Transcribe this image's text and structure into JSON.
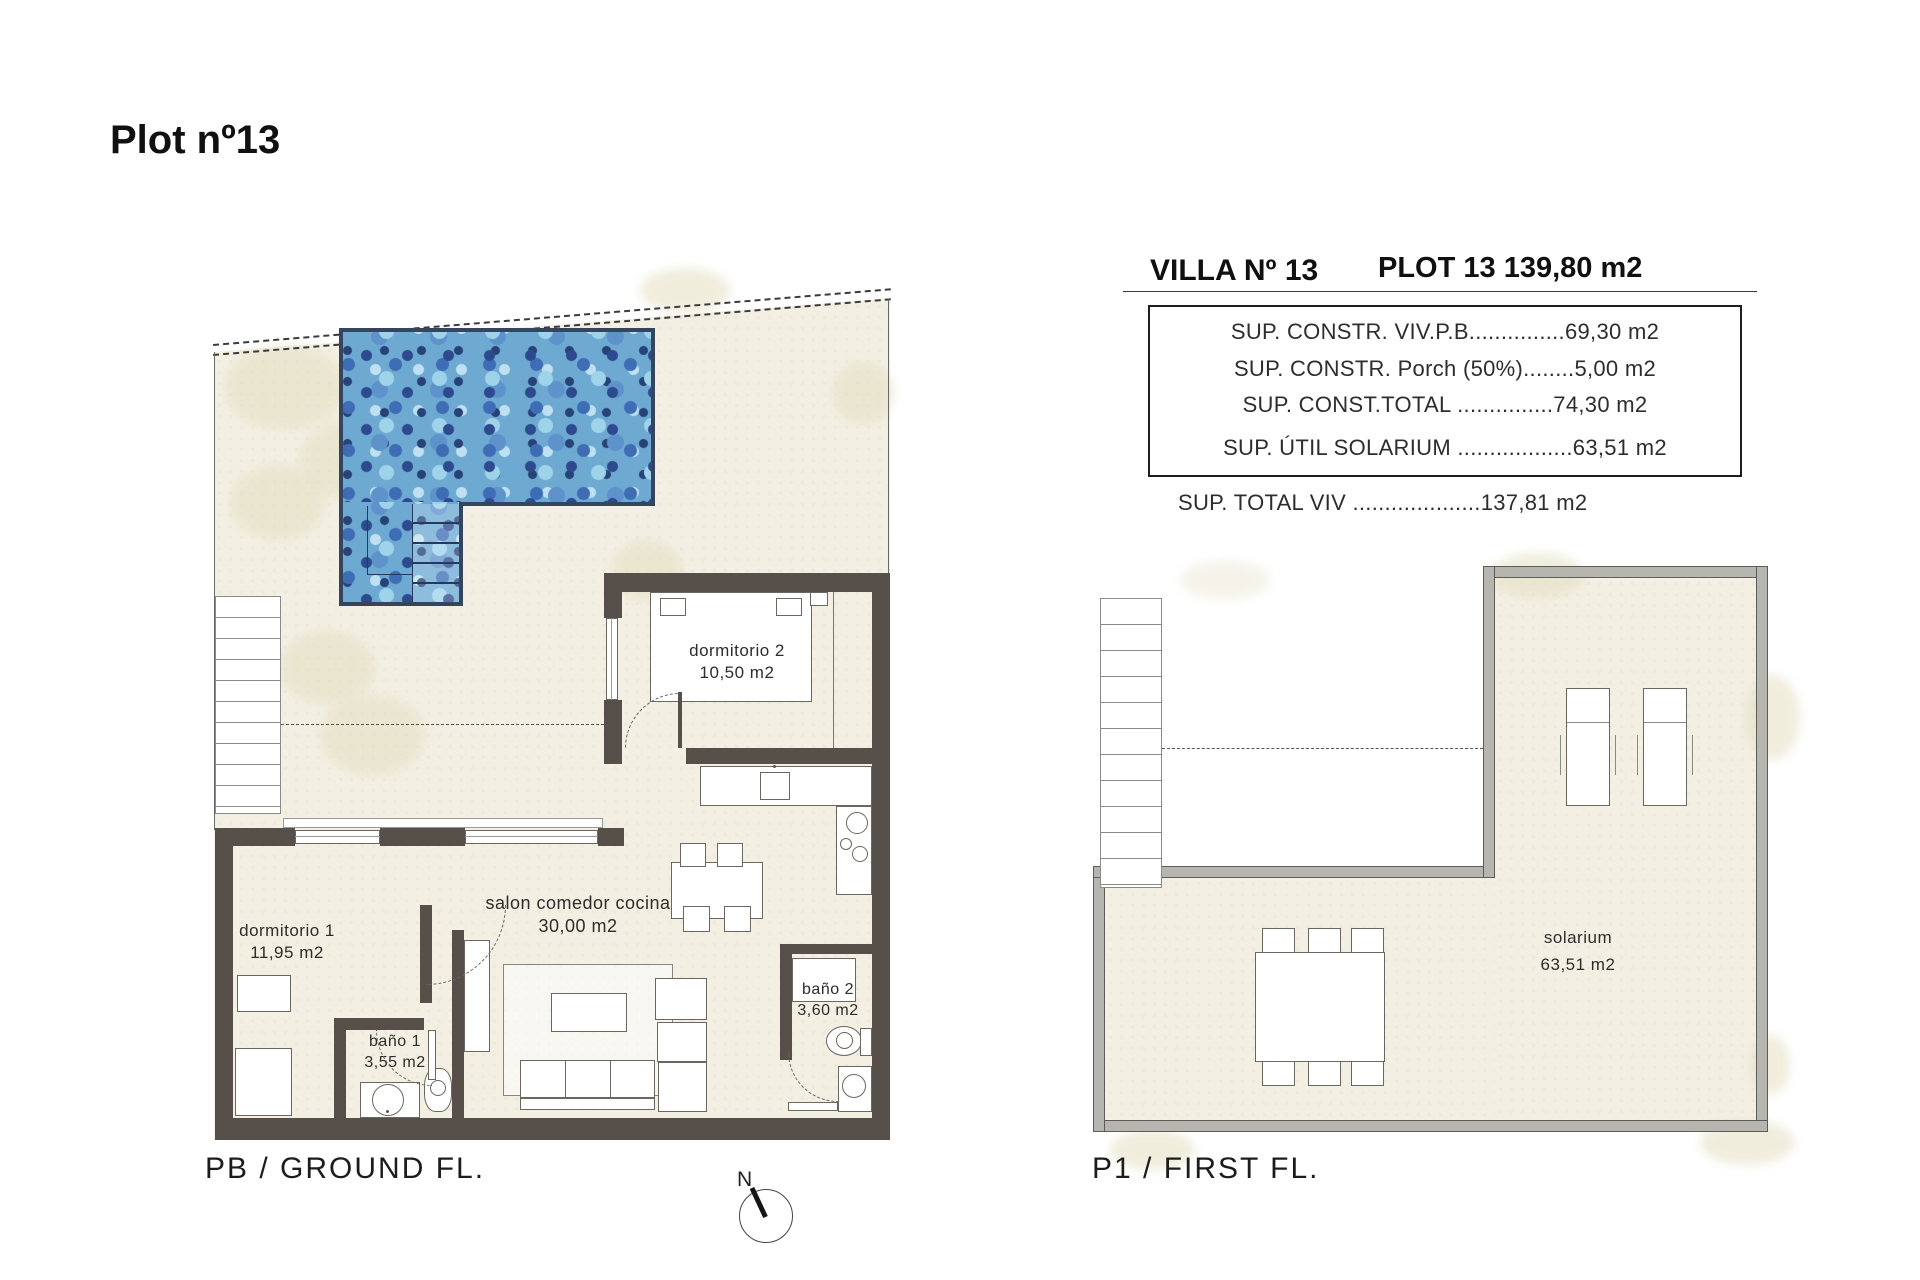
{
  "page": {
    "title": "Plot nº13"
  },
  "header": {
    "villa": "VILLA Nº 13",
    "plot": "PLOT 13 139,80 m2"
  },
  "areas": {
    "rows": [
      {
        "text": "SUP. CONSTR. VIV.P.B...............69,30 m2"
      },
      {
        "text": "SUP. CONSTR. Porch (50%)........5,00 m2"
      },
      {
        "text": "SUP. CONST.TOTAL ...............74,30 m2"
      },
      {
        "text": "SUP. ÚTIL SOLARIUM ..................63,51 m2"
      }
    ],
    "total": "SUP. TOTAL VIV ....................137,81 m2"
  },
  "ground_floor": {
    "caption": "PB / GROUND FL.",
    "rooms": {
      "dormitorio2": {
        "name": "dormitorio 2",
        "area": "10,50 m2"
      },
      "dormitorio1": {
        "name": "dormitorio 1",
        "area": "11,95 m2"
      },
      "salon": {
        "name": "salon comedor cocina",
        "area": "30,00 m2"
      },
      "bano1": {
        "name": "baño 1",
        "area": "3,55 m2"
      },
      "bano2": {
        "name": "baño 2",
        "area": "3,60 m2"
      }
    }
  },
  "first_floor": {
    "caption": "P1 / FIRST FL.",
    "rooms": {
      "solarium": {
        "name": "solarium",
        "area": "63,51 m2"
      }
    }
  },
  "compass": {
    "label": "N"
  },
  "colors": {
    "wall_dark": "#57504a",
    "wall_gray": "#b7b5b0",
    "plot_beige": "#f3efe3",
    "pool_blue": "#6ea9d2"
  }
}
